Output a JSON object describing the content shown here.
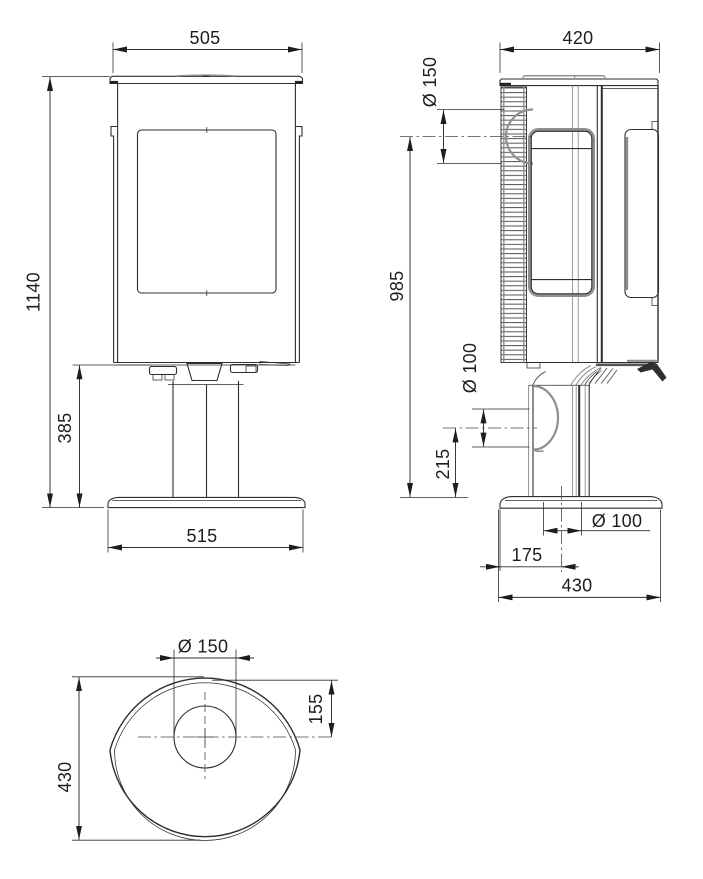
{
  "drawing": {
    "type": "technical-dimension-drawing",
    "subject": "pedestal stove, three orthographic views",
    "background_color": "#ffffff",
    "line_color": "#2e2e2e",
    "secondary_line_color": "#8f8f8f",
    "views": {
      "front": {
        "id": "front-view",
        "dimensions": {
          "top_width": "505",
          "overall_height": "1140",
          "pedestal_height": "385",
          "base_width": "515"
        }
      },
      "side": {
        "id": "side-view",
        "dimensions": {
          "top_depth": "420",
          "flue_diameter": "Ø 150",
          "flue_center_height": "985",
          "rear_inlet_diameter": "Ø 100",
          "rear_inlet_center_height": "215",
          "floor_inlet_diameter": "Ø 100",
          "floor_inlet_center_offset": "175",
          "base_depth": "430"
        }
      },
      "top": {
        "id": "top-view",
        "dimensions": {
          "flue_diameter": "Ø 150",
          "flue_center_from_rear": "155",
          "body_depth": "430"
        }
      }
    }
  }
}
